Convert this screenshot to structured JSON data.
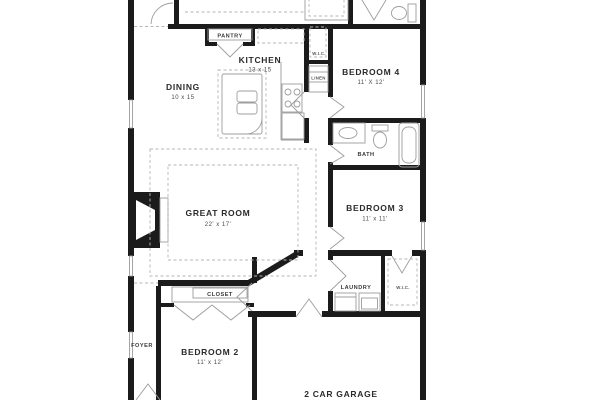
{
  "plan": {
    "type": "single-story-floor-plan",
    "colors": {
      "wall": "#1b1b1b",
      "thin_line": "#9c9c9c",
      "dashed_line": "#b5b5b5",
      "label_text": "#2b2b2b",
      "dim_text": "#4a4a4a",
      "background": "#ffffff"
    },
    "rooms": {
      "pantry": {
        "name": "PANTRY"
      },
      "kitchen": {
        "name": "KITCHEN",
        "dims": "13 x 15"
      },
      "dining": {
        "name": "DINING",
        "dims": "10 x 15"
      },
      "great_room": {
        "name": "GREAT ROOM",
        "dims": "22' x 17'"
      },
      "bedroom4": {
        "name": "BEDROOM 4",
        "dims": "11' X 12'"
      },
      "wic_top": {
        "name": "W.I.C."
      },
      "linen": {
        "name": "LINEN"
      },
      "bath": {
        "name": "BATH"
      },
      "bedroom3": {
        "name": "BEDROOM 3",
        "dims": "11' x 11'"
      },
      "laundry": {
        "name": "LAUNDRY"
      },
      "wic_bottom": {
        "name": "W.I.C."
      },
      "closet": {
        "name": "CLOSET"
      },
      "foyer": {
        "name": "FOYER"
      },
      "bedroom2": {
        "name": "BEDROOM 2",
        "dims": "11' x 12'"
      },
      "garage": {
        "name": "2 CAR GARAGE"
      }
    },
    "fixtures": [
      "fireplace",
      "kitchen-island-sink",
      "range",
      "refrigerator",
      "shower",
      "toilet",
      "bathtub",
      "vanity-sink",
      "washer",
      "dryer",
      "wardrobe-rods",
      "pantry-shelf"
    ]
  }
}
